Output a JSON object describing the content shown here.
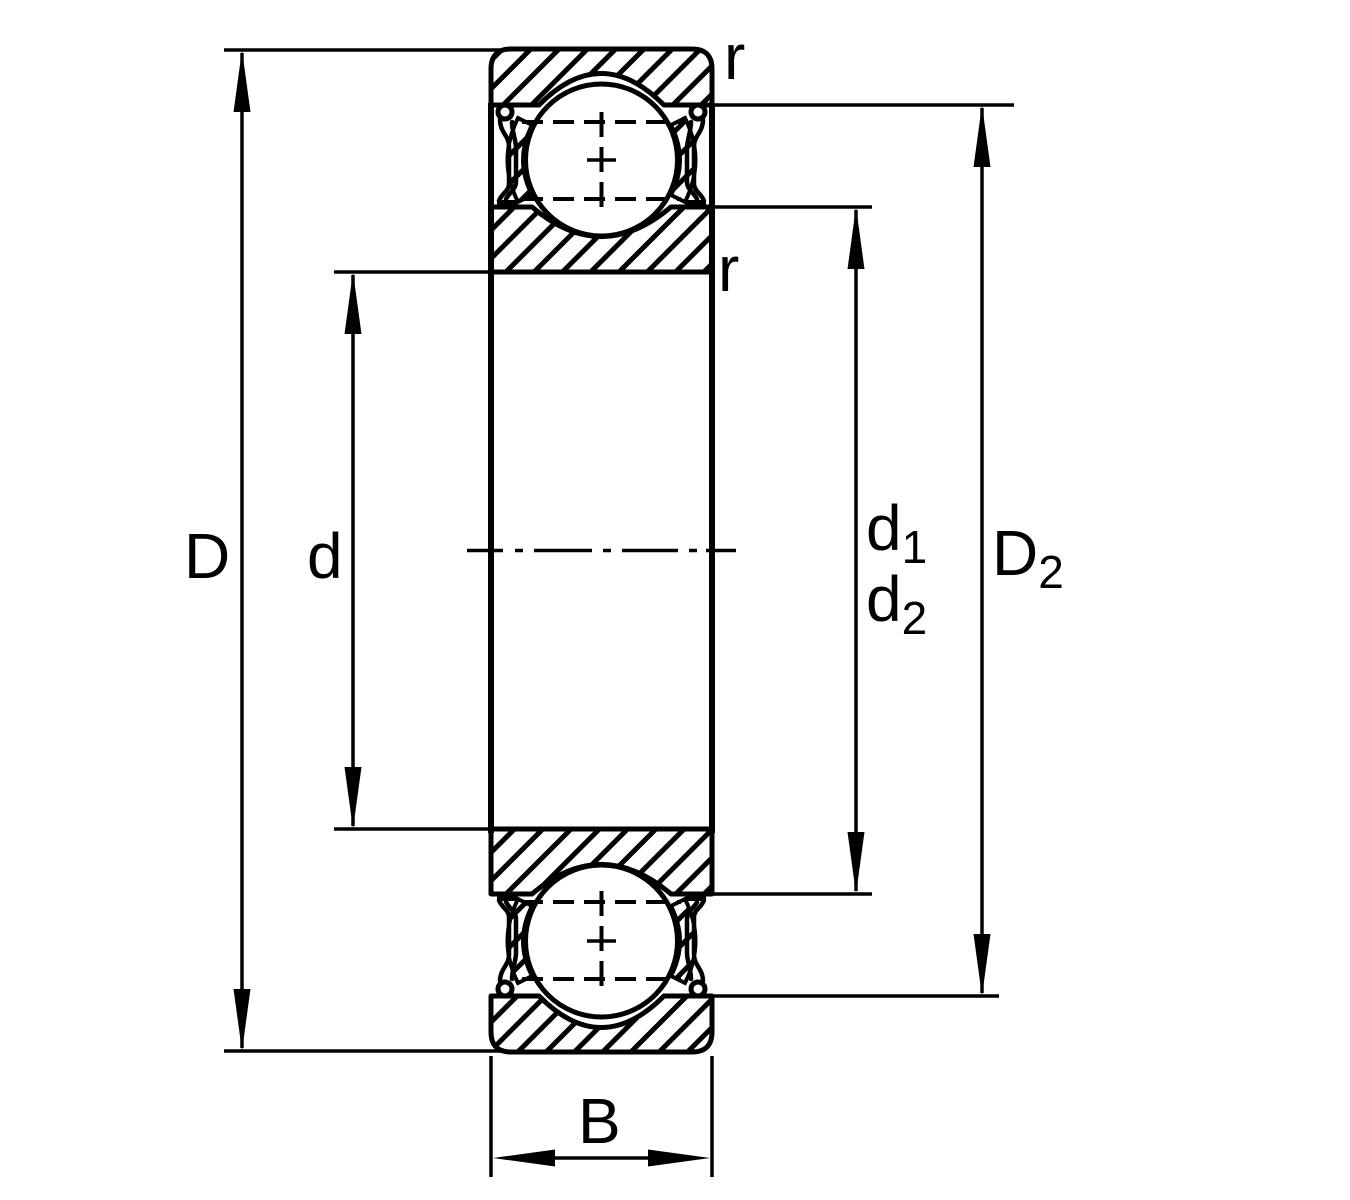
{
  "colors": {
    "line": "#000000",
    "background": "#ffffff"
  },
  "labels": {
    "D": "D",
    "d": "d",
    "d1": {
      "base": "d",
      "sub": "1"
    },
    "d2": {
      "base": "d",
      "sub": "2"
    },
    "D2": {
      "base": "D",
      "sub": "2"
    },
    "B": "B",
    "r_outer": "r",
    "r_inner": "r"
  }
}
